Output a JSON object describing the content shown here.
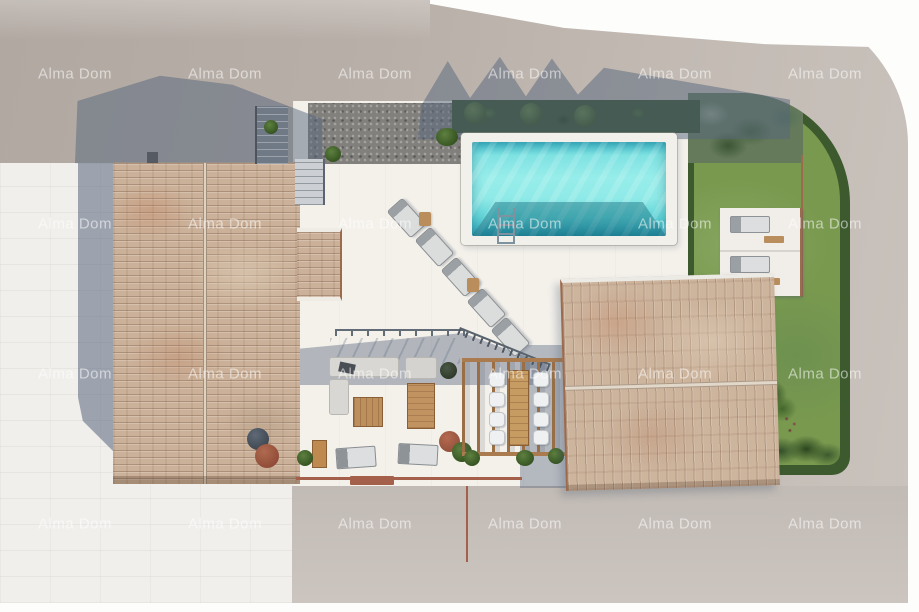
{
  "image": {
    "type": "architectural-aerial-render",
    "subject": "Top-down 3D rendering of a villa plot: main house with terracotta tiled roof, second tiled-roof building, turquoise swimming pool with ladder, white stone terraces with sun loungers, lounge sofa set, pergola-covered dining table with eight chairs, external staircase, gravel and hedge strips, lawn garden with trees bordered by hedges, surrounding asphalt road with curved corner"
  },
  "watermark": {
    "text": "Alma Dom",
    "color": "rgba(255,255,255,0.55)",
    "font_size_px": 15,
    "grid_x": [
      75,
      225,
      375,
      525,
      675,
      825
    ],
    "grid_y": [
      74,
      224,
      374,
      524
    ]
  },
  "palette": {
    "page_bg": "#fdfdfc",
    "road": "#bcb3ac",
    "road_light": "#cac3bd",
    "stone_pavement": "#f1efec",
    "terrace": "#f4f1eb",
    "pool_water": "#8feae7",
    "pool_deep": "#2fa4b8",
    "roof_tile": "#cdb49d",
    "roof_edge_line": "#9c6a4c",
    "grass": "#79994f",
    "hedge": "#3c5a2d",
    "shadow": "rgba(86,101,124,0.50)",
    "wood": "#b98d5c",
    "terracotta_line": "#a4604a"
  },
  "scene_elements": [
    "asphalt road with curved top-right corner",
    "white stone pavement (left)",
    "taupe pavement (bottom right)",
    "main house tiled roof with ridge and chimney",
    "roof extension wing",
    "second building tiled roof",
    "swimming pool with white coping and ladder",
    "five sun loungers with wooden side tables",
    "garden lawn with hedge border, tree and flower bush",
    "two lounger alcoves",
    "outdoor sofa set with coffee table and wooden deck",
    "pergola dining area with long table and eight chairs",
    "external staircase with two flights",
    "gravel strip and trimmed hedge with three round bushes",
    "building and tree shadows",
    "terracotta boundary lines and doormat"
  ]
}
